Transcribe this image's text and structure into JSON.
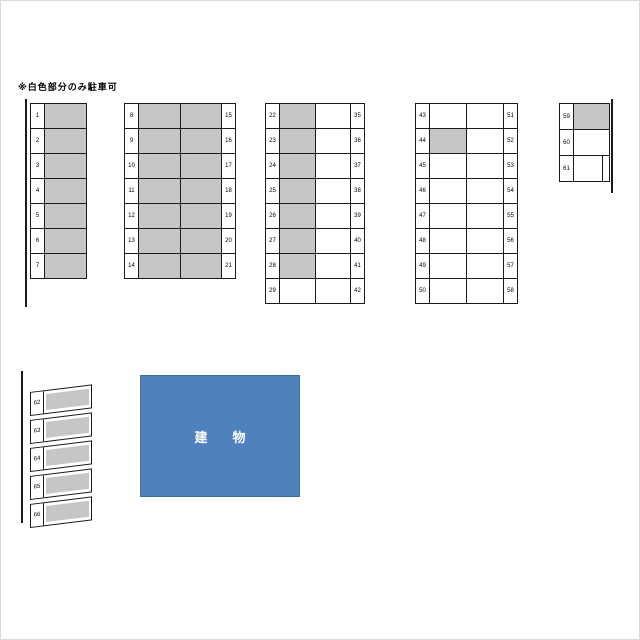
{
  "note": "※白色部分のみ駐車可",
  "building": {
    "label": "建　物",
    "color": "#4f81bd"
  },
  "colors": {
    "occupied_fill": "#c6c6c6",
    "available_fill": "#ffffff",
    "line": "#1a1a1a",
    "building": "#4f81bd"
  },
  "blocks": {
    "b1": {
      "rows": [
        {
          "l": "1",
          "cells": [
            true
          ]
        },
        {
          "l": "2",
          "cells": [
            true
          ]
        },
        {
          "l": "3",
          "cells": [
            true
          ]
        },
        {
          "l": "4",
          "cells": [
            true
          ]
        },
        {
          "l": "5",
          "cells": [
            true
          ]
        },
        {
          "l": "6",
          "cells": [
            true
          ]
        },
        {
          "l": "7",
          "cells": [
            true
          ]
        }
      ]
    },
    "b2": {
      "rows": [
        {
          "l": "8",
          "cells": [
            true,
            true
          ],
          "r": "15"
        },
        {
          "l": "9",
          "cells": [
            true,
            true
          ],
          "r": "16"
        },
        {
          "l": "10",
          "cells": [
            true,
            true
          ],
          "r": "17"
        },
        {
          "l": "11",
          "cells": [
            true,
            true
          ],
          "r": "18"
        },
        {
          "l": "12",
          "cells": [
            true,
            true
          ],
          "r": "19"
        },
        {
          "l": "13",
          "cells": [
            true,
            true
          ],
          "r": "20"
        },
        {
          "l": "14",
          "cells": [
            true,
            true
          ],
          "r": "21"
        }
      ]
    },
    "b3": {
      "rows": [
        {
          "l": "22",
          "cells": [
            true,
            false
          ],
          "r": "35"
        },
        {
          "l": "23",
          "cells": [
            true,
            false
          ],
          "r": "36"
        },
        {
          "l": "24",
          "cells": [
            true,
            false
          ],
          "r": "37"
        },
        {
          "l": "25",
          "cells": [
            true,
            false
          ],
          "r": "38"
        },
        {
          "l": "26",
          "cells": [
            true,
            false
          ],
          "r": "39"
        },
        {
          "l": "27",
          "cells": [
            true,
            false
          ],
          "r": "40"
        },
        {
          "l": "28",
          "cells": [
            true,
            false
          ],
          "r": "41"
        },
        {
          "l": "29",
          "cells": [
            false,
            false
          ],
          "r": "42"
        }
      ]
    },
    "b4": {
      "rows": [
        {
          "l": "43",
          "cells": [
            false,
            false
          ],
          "r": "51"
        },
        {
          "l": "44",
          "cells": [
            true,
            false
          ],
          "r": "52"
        },
        {
          "l": "45",
          "cells": [
            false,
            false
          ],
          "r": "53"
        },
        {
          "l": "46",
          "cells": [
            false,
            false
          ],
          "r": "54"
        },
        {
          "l": "47",
          "cells": [
            false,
            false
          ],
          "r": "55"
        },
        {
          "l": "48",
          "cells": [
            false,
            false
          ],
          "r": "56"
        },
        {
          "l": "49",
          "cells": [
            false,
            false
          ],
          "r": "57"
        },
        {
          "l": "50",
          "cells": [
            false,
            false
          ],
          "r": "58"
        }
      ]
    },
    "b5": {
      "rows": [
        {
          "l": "59",
          "cells": [
            true
          ]
        },
        {
          "l": "60",
          "cells": [
            false
          ]
        },
        {
          "l": "61",
          "cells": [
            false
          ]
        }
      ]
    },
    "b6": {
      "rows": [
        {
          "l": "62",
          "cells": [
            true
          ]
        },
        {
          "l": "63",
          "cells": [
            true
          ]
        },
        {
          "l": "64",
          "cells": [
            true
          ]
        },
        {
          "l": "65",
          "cells": [
            true
          ]
        },
        {
          "l": "66",
          "cells": [
            true
          ]
        }
      ]
    }
  }
}
